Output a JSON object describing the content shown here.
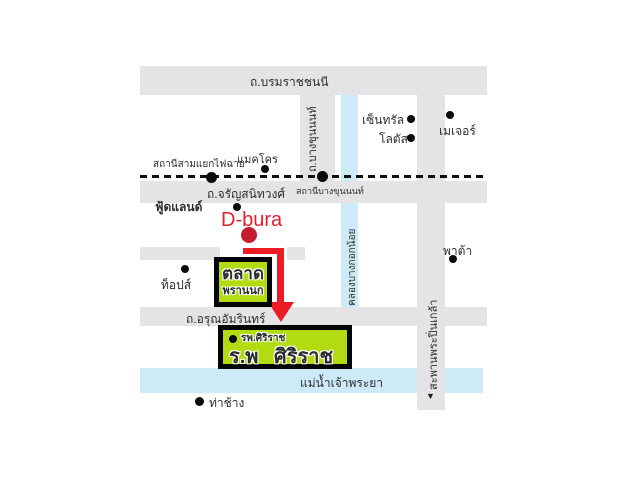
{
  "roads": {
    "borommaratchachonnani": "ถ.บรมราชชนนี",
    "charansanitwong": "ถ.จรัญสนิทวงศ์",
    "arunamarin": "ถ.อรุณอัมรินทร์",
    "bangkhunnon": "ถ.บางขุนนนท์",
    "pinklao_bridge": "สะพานพระปิ่นเกล้า",
    "bridge_arrow": "▼"
  },
  "waterways": {
    "canal": "คลองบางกอกน้อย",
    "river": "แม่น้ำเจ้าพระยา"
  },
  "stations": {
    "faichai": "สถานีสามแยกไฟฉาย",
    "bangkhunnon": "สถานีบางขุนนนท์"
  },
  "places": {
    "makro": "แมคโคร",
    "foodland": "ฟู้ดแลนด์",
    "dbura": "D-bura",
    "central": "เซ็นทรัล",
    "lotus": "โลตัส",
    "major": "เมเจอร์",
    "tops": "ท็อปส์",
    "pata": "พาต้า",
    "thachang": "ท่าช้าง"
  },
  "market": {
    "line1": "ตลาด",
    "line2": "พรานนก"
  },
  "hospital": {
    "small_label": "รพ.ศิริราช",
    "name": "ร.พ ศิริราช"
  },
  "colors": {
    "road_gray": "#e4e4e6",
    "water_blue": "#cdeaf7",
    "highlight_green": "#b2dc11",
    "arrow_red": "#ed1b24",
    "dbura_red": "#e3202c"
  }
}
